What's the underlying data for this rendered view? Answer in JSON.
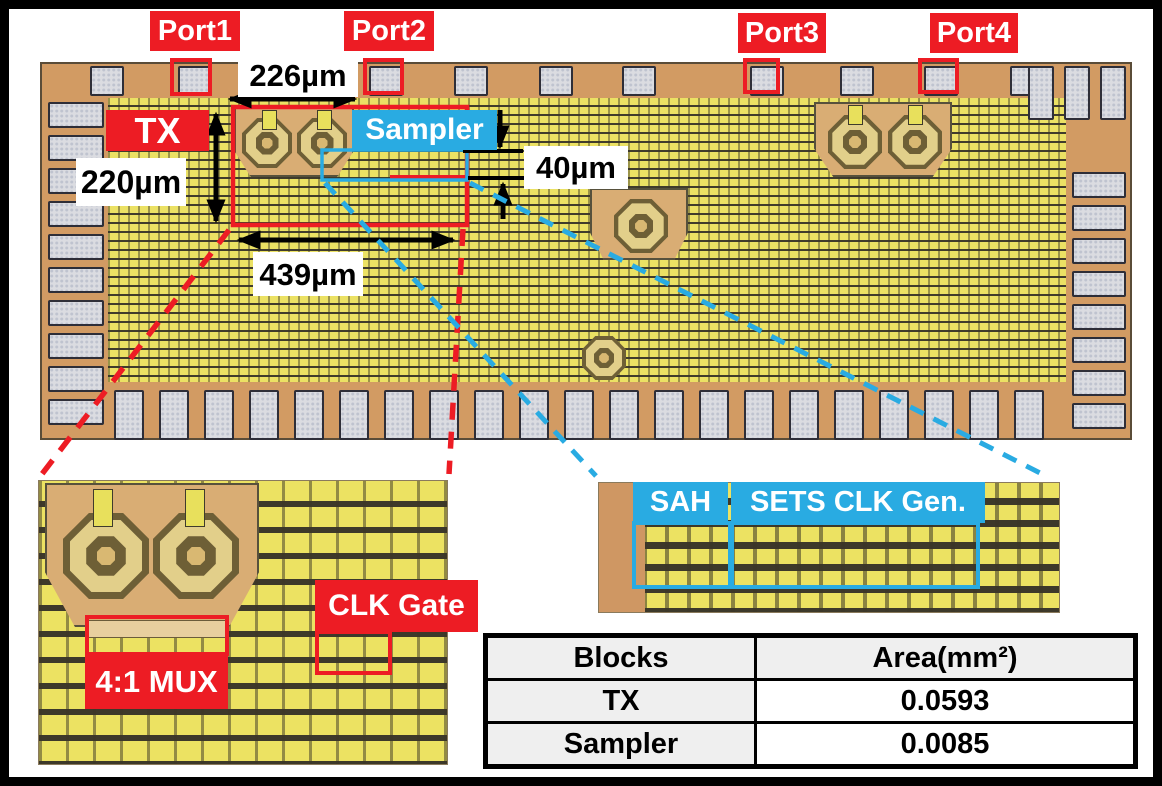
{
  "figure": {
    "ports": [
      "Port1",
      "Port2",
      "Port3",
      "Port4"
    ],
    "blocks": {
      "tx": "TX",
      "sampler": "Sampler",
      "mux": "4:1 MUX",
      "clk_gate": "CLK Gate",
      "sah": "SAH",
      "sets_clk_gen": "SETS CLK Gen."
    },
    "dimensions": {
      "top_width": "226µm",
      "tx_height": "220µm",
      "tx_width": "439µm",
      "sampler_height": "40µm"
    },
    "colors": {
      "annotation_red": "#ed1c24",
      "annotation_cyan": "#29abe2",
      "label_text": "#ffffff",
      "dimension_text": "#000000"
    }
  },
  "area_table": {
    "headers": [
      "Blocks",
      "Area(mm²)"
    ],
    "rows": [
      {
        "block": "TX",
        "area": "0.0593"
      },
      {
        "block": "Sampler",
        "area": "0.0085"
      }
    ]
  }
}
